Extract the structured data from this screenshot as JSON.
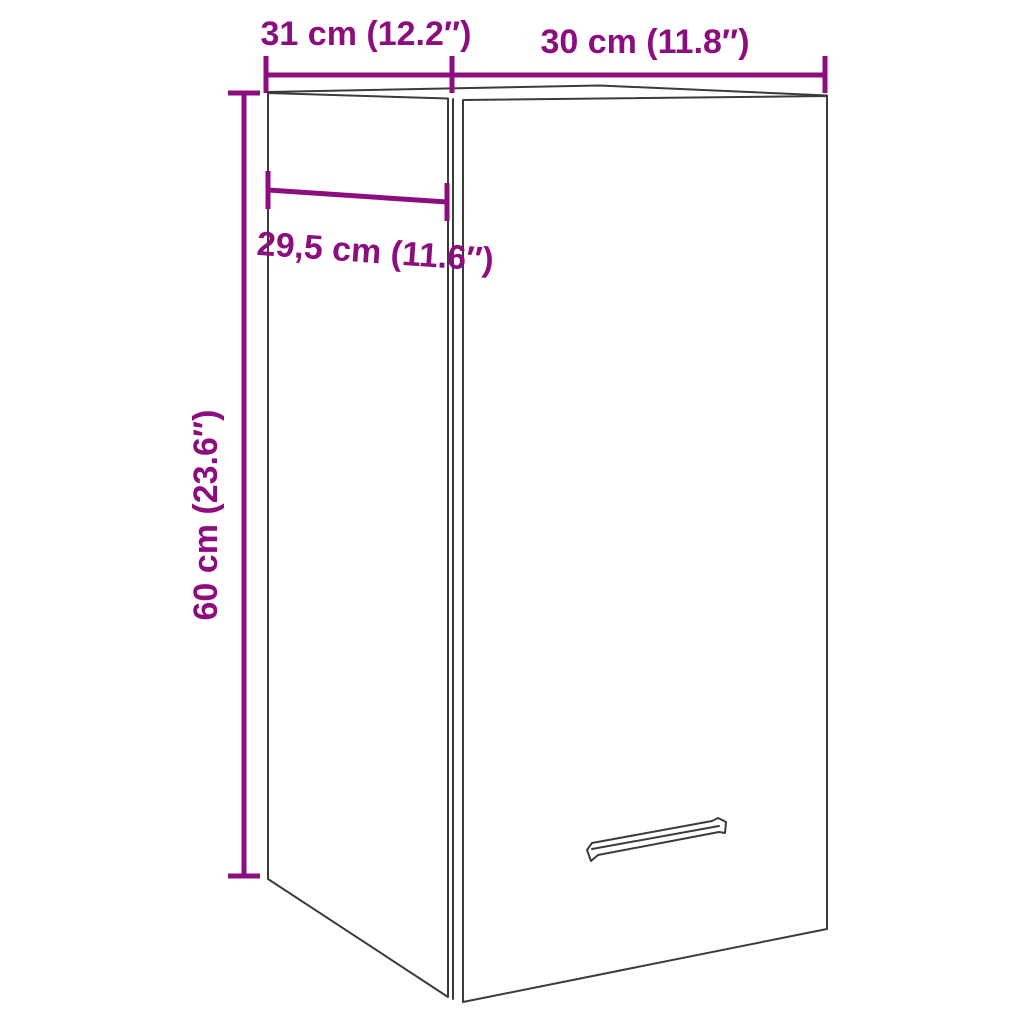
{
  "canvas": {
    "width": 1024,
    "height": 1024,
    "background": "#FFFFFF"
  },
  "style": {
    "accent_color": "#8C0E7E",
    "wireframe_color": "#3B3B3B"
  },
  "diagram": {
    "kind": "furniture-dimension-diagram",
    "subject": "wall-hung-cabinet-with-door-and-handle"
  },
  "labels": {
    "depth_top": "31 cm (12.2″)",
    "width_top": "30 cm (11.8″)",
    "inner_depth": "29,5 cm (11.6″)",
    "height": "60 cm (23.6″)"
  }
}
